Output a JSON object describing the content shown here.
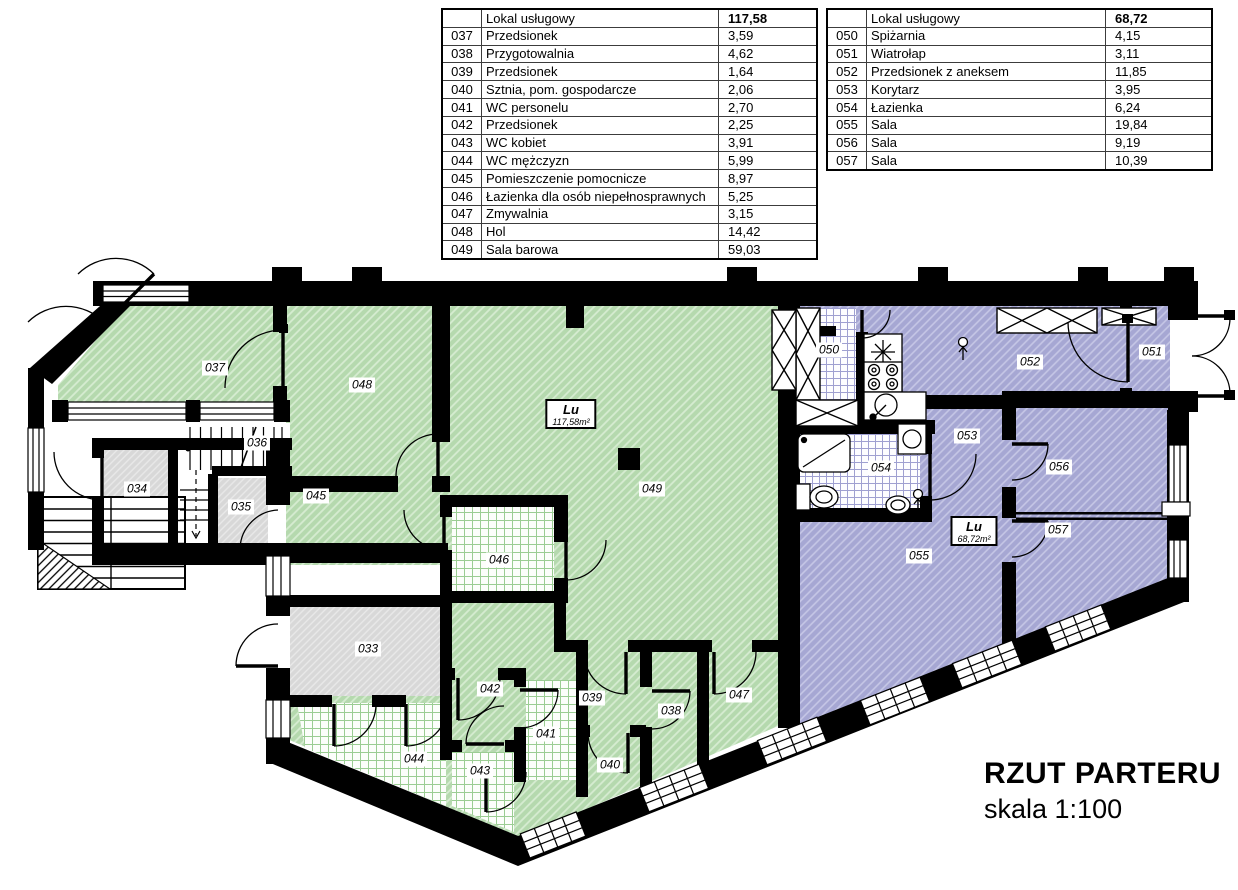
{
  "legend": {
    "green_fill": "#b5d9ae",
    "purple_fill": "#a6a7d3"
  },
  "tables": [
    {
      "id": "lokal-uslugowy-green",
      "header": {
        "label": "Lokal usługowy",
        "total": "117,58"
      },
      "rows": [
        [
          "037",
          "Przedsionek",
          "3,59"
        ],
        [
          "038",
          "Przygotowalnia",
          "4,62"
        ],
        [
          "039",
          "Przedsionek",
          "1,64"
        ],
        [
          "040",
          "Sztnia, pom. gospodarcze",
          "2,06"
        ],
        [
          "041",
          "WC personelu",
          "2,70"
        ],
        [
          "042",
          "Przedsionek",
          "2,25"
        ],
        [
          "043",
          "WC kobiet",
          "3,91"
        ],
        [
          "044",
          "WC mężczyzn",
          "5,99"
        ],
        [
          "045",
          "Pomieszczenie pomocnicze",
          "8,97"
        ],
        [
          "046",
          "Łazienka dla osób niepełnosprawnych",
          "5,25"
        ],
        [
          "047",
          "Zmywalnia",
          "3,15"
        ],
        [
          "048",
          "Hol",
          "14,42"
        ],
        [
          "049",
          "Sala barowa",
          "59,03"
        ]
      ]
    },
    {
      "id": "lokal-uslugowy-purple",
      "header": {
        "label": "Lokal usługowy",
        "total": "68,72"
      },
      "rows": [
        [
          "050",
          "Spiżarnia",
          "4,15"
        ],
        [
          "051",
          "Wiatrołap",
          "3,11"
        ],
        [
          "052",
          "Przedsionek z aneksem",
          "11,85"
        ],
        [
          "053",
          "Korytarz",
          "3,95"
        ],
        [
          "054",
          "Łazienka",
          "6,24"
        ],
        [
          "055",
          "Sala",
          "19,84"
        ],
        [
          "056",
          "Sala",
          "9,19"
        ],
        [
          "057",
          "Sala",
          "10,39"
        ]
      ]
    }
  ],
  "plan": {
    "title": "RZUT PARTERU",
    "scale": "skala 1:100",
    "room_labels": [
      {
        "text": "033",
        "x": 368,
        "y": 649
      },
      {
        "text": "034",
        "x": 137,
        "y": 489
      },
      {
        "text": "035",
        "x": 241,
        "y": 507
      },
      {
        "text": "036",
        "x": 257,
        "y": 443
      },
      {
        "text": "037",
        "x": 215,
        "y": 368
      },
      {
        "text": "038",
        "x": 671,
        "y": 711
      },
      {
        "text": "039",
        "x": 592,
        "y": 698
      },
      {
        "text": "040",
        "x": 610,
        "y": 765
      },
      {
        "text": "041",
        "x": 546,
        "y": 734
      },
      {
        "text": "042",
        "x": 490,
        "y": 689
      },
      {
        "text": "043",
        "x": 480,
        "y": 771
      },
      {
        "text": "044",
        "x": 414,
        "y": 759
      },
      {
        "text": "045",
        "x": 316,
        "y": 496
      },
      {
        "text": "046",
        "x": 499,
        "y": 560
      },
      {
        "text": "047",
        "x": 739,
        "y": 695
      },
      {
        "text": "048",
        "x": 362,
        "y": 385
      },
      {
        "text": "049",
        "x": 652,
        "y": 489
      },
      {
        "text": "050",
        "x": 829,
        "y": 350
      },
      {
        "text": "051",
        "x": 1152,
        "y": 352
      },
      {
        "text": "052",
        "x": 1030,
        "y": 362
      },
      {
        "text": "053",
        "x": 967,
        "y": 436
      },
      {
        "text": "054",
        "x": 881,
        "y": 468
      },
      {
        "text": "055",
        "x": 919,
        "y": 556
      },
      {
        "text": "056",
        "x": 1059,
        "y": 467
      },
      {
        "text": "057",
        "x": 1058,
        "y": 530
      }
    ],
    "area_labels": [
      {
        "title": "Lu",
        "area": "117,58m²",
        "x": 571,
        "y": 414
      },
      {
        "title": "Lu",
        "area": "68,72m²",
        "x": 974,
        "y": 531
      }
    ]
  }
}
